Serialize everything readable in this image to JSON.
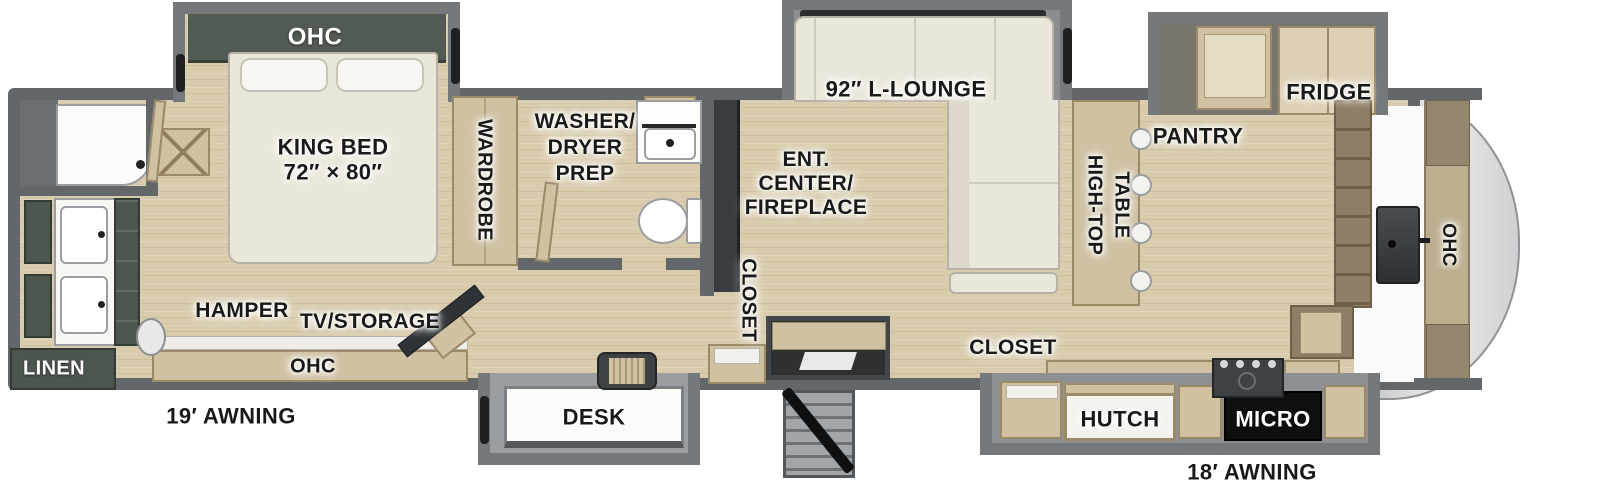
{
  "title": "Fifth wheel RV floor plan",
  "colors": {
    "wall": "#63676a",
    "slide_wall": "#75797c",
    "floor_wood": "#d9ccad",
    "cabinet_wood": "#cfc1a2",
    "dark_cabinet_green": "#4c564f",
    "fixture_white": "#f7f6f2",
    "label_text": "#191919",
    "front_cap": "#dcdddf"
  },
  "bedroom": {
    "ohc_slide": "OHC",
    "king_bed": "KING BED",
    "king_bed_size": "72″ × 80″",
    "wardrobe": "WARDROBE",
    "hamper": "HAMPER",
    "tv_storage": "TV/STORAGE",
    "ohc_cabinet": "OHC"
  },
  "front_bath": {
    "linen": "LINEN"
  },
  "mid_bath": {
    "washer_line1": "WASHER/",
    "washer_line2": "DRYER",
    "washer_line3": "PREP"
  },
  "living": {
    "lounge": "92″ L-LOUNGE",
    "ent_center_line1": "ENT.",
    "ent_center_line2": "CENTER/",
    "ent_center_line3": "FIREPLACE",
    "closet_entry": "CLOSET",
    "desk": "DESK"
  },
  "kitchen": {
    "high_top_line1": "HIGH-TOP",
    "high_top_line2": "TABLE",
    "pantry": "PANTRY",
    "fridge": "FRIDGE",
    "closet": "CLOSET",
    "hutch": "HUTCH",
    "micro": "MICRO",
    "ohc_front": "OHC"
  },
  "exterior": {
    "awning_rear": "19′ AWNING",
    "awning_front": "18′ AWNING"
  }
}
